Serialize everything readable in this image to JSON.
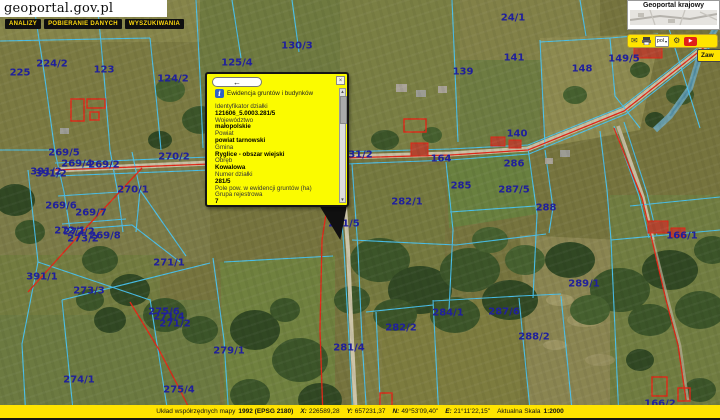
{
  "header": {
    "logo": "geoportal.gov.pl",
    "menu": [
      "ANALIZY",
      "POBIERANIE DANYCH",
      "WYSZUKIWANIA"
    ]
  },
  "panel": {
    "title": "Geoportal krajowy",
    "side_tab": "Zaw"
  },
  "toolbar": {
    "language": "pol",
    "icons": [
      "mail-icon",
      "print-icon",
      "language-select",
      "settings-icon",
      "video-button"
    ]
  },
  "popup": {
    "back_arrow": "←",
    "close": "×",
    "title": "Ewidencja gruntów i budynków",
    "fields": [
      {
        "label": "Identyfikator działki",
        "value": "121606_5.0003.281/5"
      },
      {
        "label": "Województwo",
        "value": "małopolskie"
      },
      {
        "label": "Powiat",
        "value": "powiat tarnowski"
      },
      {
        "label": "Gmina",
        "value": "Ryglice - obszar wiejski"
      },
      {
        "label": "Obręb",
        "value": "Kowalowa"
      },
      {
        "label": "Numer działki",
        "value": "281/5"
      },
      {
        "label": "Pole pow. w ewidencji gruntów (ha)",
        "value": ""
      },
      {
        "label": "Grupa rejestrowa",
        "value": "7"
      },
      {
        "label": "Oznaczenie użytku",
        "value": ""
      },
      {
        "label": "Oznaczenie konturu",
        "value": ""
      }
    ]
  },
  "statusbar": {
    "crs_label": "Układ współrzędnych mapy",
    "crs_value": "1992 (EPSG 2180)",
    "x_label": "X:",
    "x_value": "226589,28",
    "y_label": "Y:",
    "y_value": "657231,37",
    "n_label": "N:",
    "n_value": "49°53'09,40\"",
    "e_label": "E:",
    "e_value": "21°11'22,15\"",
    "scale_label": "Aktualna Skala",
    "scale_value": "1:2000"
  },
  "map": {
    "labels": [
      {
        "t": "24/1",
        "x": 513,
        "y": 18
      },
      {
        "t": "225",
        "x": 20,
        "y": 73
      },
      {
        "t": "224/2",
        "x": 52,
        "y": 64
      },
      {
        "t": "123",
        "x": 104,
        "y": 70
      },
      {
        "t": "124/2",
        "x": 173,
        "y": 79
      },
      {
        "t": "125/4",
        "x": 237,
        "y": 63
      },
      {
        "t": "130/3",
        "x": 297,
        "y": 46
      },
      {
        "t": "139",
        "x": 463,
        "y": 72
      },
      {
        "t": "141",
        "x": 514,
        "y": 58
      },
      {
        "t": "148",
        "x": 582,
        "y": 69
      },
      {
        "t": "149/5",
        "x": 624,
        "y": 59
      },
      {
        "t": "140",
        "x": 517,
        "y": 134
      },
      {
        "t": "131/2",
        "x": 357,
        "y": 155
      },
      {
        "t": "164",
        "x": 441,
        "y": 159
      },
      {
        "t": "286",
        "x": 514,
        "y": 164
      },
      {
        "t": "285",
        "x": 461,
        "y": 186
      },
      {
        "t": "287/5",
        "x": 514,
        "y": 190
      },
      {
        "t": "288",
        "x": 546,
        "y": 208
      },
      {
        "t": "269/5",
        "x": 64,
        "y": 153
      },
      {
        "t": "269/4",
        "x": 77,
        "y": 164
      },
      {
        "t": "269/2",
        "x": 104,
        "y": 165
      },
      {
        "t": "270/2",
        "x": 174,
        "y": 157
      },
      {
        "t": "391/2",
        "x": 46,
        "y": 172
      },
      {
        "t": "391/2",
        "x": 51,
        "y": 174
      },
      {
        "t": "270/1",
        "x": 133,
        "y": 190
      },
      {
        "t": "269/6",
        "x": 61,
        "y": 206
      },
      {
        "t": "269/7",
        "x": 91,
        "y": 213
      },
      {
        "t": "272/1",
        "x": 70,
        "y": 231
      },
      {
        "t": "272/2",
        "x": 79,
        "y": 232
      },
      {
        "t": "273/2",
        "x": 83,
        "y": 239
      },
      {
        "t": "269/8",
        "x": 105,
        "y": 236
      },
      {
        "t": "271/1",
        "x": 169,
        "y": 263
      },
      {
        "t": "391/1",
        "x": 42,
        "y": 277
      },
      {
        "t": "273/3",
        "x": 89,
        "y": 291
      },
      {
        "t": "275/6",
        "x": 164,
        "y": 312
      },
      {
        "t": "271/4",
        "x": 169,
        "y": 317
      },
      {
        "t": "271/2",
        "x": 175,
        "y": 324
      },
      {
        "t": "279/1",
        "x": 229,
        "y": 351
      },
      {
        "t": "274/1",
        "x": 79,
        "y": 380
      },
      {
        "t": "275/4",
        "x": 179,
        "y": 390
      },
      {
        "t": "281/5",
        "x": 344,
        "y": 224
      },
      {
        "t": "282/1",
        "x": 407,
        "y": 202
      },
      {
        "t": "282/2",
        "x": 401,
        "y": 328
      },
      {
        "t": "281/4",
        "x": 349,
        "y": 348
      },
      {
        "t": "284/1",
        "x": 448,
        "y": 313
      },
      {
        "t": "287/6",
        "x": 504,
        "y": 312
      },
      {
        "t": "288/2",
        "x": 534,
        "y": 337
      },
      {
        "t": "289/1",
        "x": 584,
        "y": 284
      },
      {
        "t": "166/1",
        "x": 682,
        "y": 236
      },
      {
        "t": "166/2",
        "x": 660,
        "y": 404
      }
    ]
  },
  "colors": {
    "accent_yellow": "#ffe400",
    "popup_yellow": "#fbfb00",
    "label_navy": "#20209b",
    "cadastral_cyan": "#49c3f2",
    "alert_red": "#e02818"
  }
}
